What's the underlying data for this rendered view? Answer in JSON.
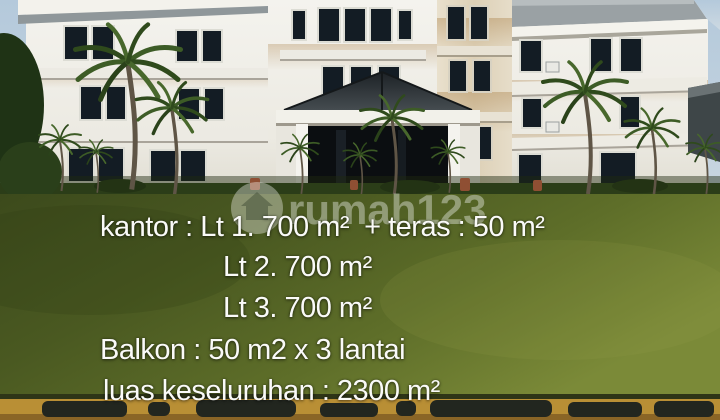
{
  "overlay": {
    "lines": [
      "kantor : Lt 1. 700 m²  + teras : 50 m²",
      "Lt 2. 700 m²",
      "Lt 3. 700 m²",
      "Balkon : 50 m2 x 3 lantai",
      "luas keseluruhan : 2300 m²"
    ]
  },
  "watermark": {
    "text": "rumah123",
    "icon": "house-in-circle-icon"
  },
  "scene": {
    "description": "Three-storey white office building with dark hip roofs, stained tower, central pillared entrance portico with pyramid tile roof, palm trees, trimmed hedge, wide lawn and yellow-black painted kerb",
    "colors": {
      "sky": "#b8cddd",
      "building": "#f0efe9",
      "roof": "#30363a",
      "window": "#131c24",
      "lawn_dark": "#3c4a1c",
      "lawn_light": "#7b8a38",
      "kerb_yellow": "#b98f35",
      "kerb_black": "#22261f",
      "overlay_text": "#fafaf8"
    }
  }
}
